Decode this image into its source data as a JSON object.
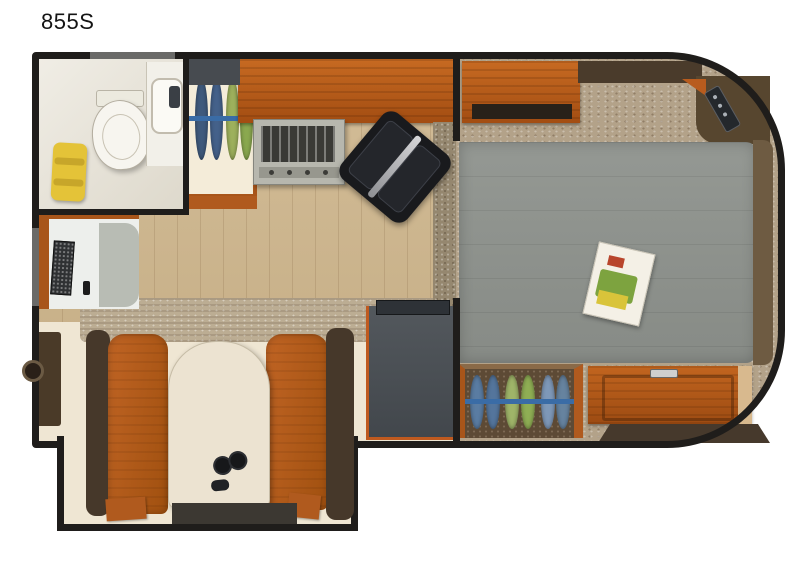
{
  "title": "855S",
  "floorplan": {
    "model": "855S",
    "type": "truck-camper-floor-plan",
    "areas": [
      {
        "name": "bathroom",
        "fixtures": [
          "toilet",
          "lavatory-sink",
          "towels"
        ]
      },
      {
        "name": "kitchen",
        "fixtures": [
          "counter",
          "range-stove",
          "double-sink",
          "dish-cabinet",
          "refrigerator"
        ]
      },
      {
        "name": "cabover-bedroom",
        "fixtures": [
          "queen-bed",
          "overhead-cabinet",
          "corner-shelf",
          "remote-control",
          "magazine",
          "shoe-storage",
          "dresser"
        ]
      },
      {
        "name": "dinette",
        "fixtures": [
          "bench-seat-left",
          "bench-seat-right",
          "table",
          "binoculars"
        ]
      },
      {
        "name": "entry",
        "fixtures": [
          "entry-door",
          "step-mat"
        ]
      },
      {
        "name": "tv-cabinet",
        "fixtures": [
          "tv"
        ]
      }
    ]
  },
  "colors": {
    "background": "#ffffff",
    "walls": "#1f1d1b",
    "cabinet_wood": "#b85c1e",
    "mattress_gray": "#8f938f",
    "carpet_tan": "#b3a289",
    "floor_wood": "#cdb691",
    "floor_cream": "#efe6d3",
    "plate_blue": "#54759c",
    "plate_green": "#9fb469",
    "towel_yellow": "#e4c338",
    "fridge_gray": "#4b5055",
    "sink_black": "#191a1d",
    "upholstery_orange": "#b8601f",
    "bench_back_brown": "#46382a",
    "table_cream": "#ece3d1"
  }
}
